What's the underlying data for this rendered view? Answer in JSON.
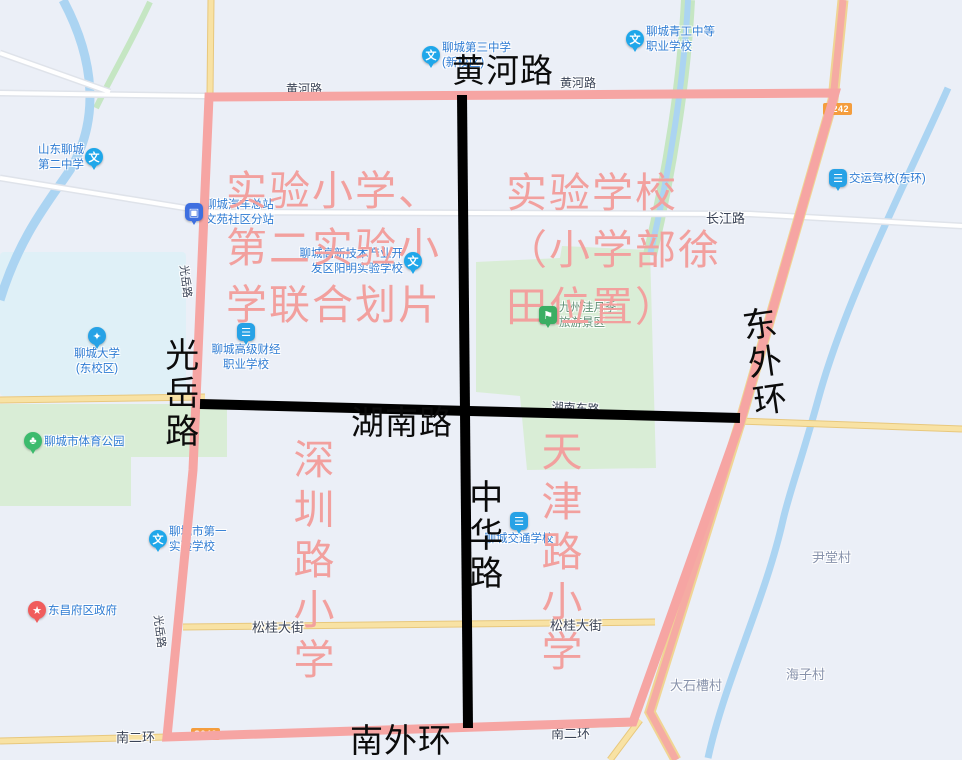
{
  "map": {
    "background_color": "#EBEFF7",
    "water_color": "#ABD4F2",
    "park_color": "#D9EDD6",
    "campus_color": "#DFF0F7",
    "road_yellow": "#F8E2A4",
    "expressway_color": "#F5ABA3",
    "pois": [
      {
        "id": "shandong-liaocheng-no2-middle-school",
        "lines": [
          "山东聊城",
          "第二中学"
        ],
        "icon": "school",
        "glyph": "文",
        "x": 94,
        "y": 157,
        "side": "left"
      },
      {
        "id": "liaocheng-no3-middle-school",
        "lines": [
          "聊城第三中学",
          "(新校区)"
        ],
        "icon": "school",
        "glyph": "文",
        "x": 431,
        "y": 55,
        "side": "right"
      },
      {
        "id": "liaocheng-qinggong-vocational-school",
        "lines": [
          "聊城青工中等",
          "职业学校"
        ],
        "icon": "school",
        "glyph": "文",
        "x": 635,
        "y": 39,
        "side": "right"
      },
      {
        "id": "jiaoyun-driving-school-donghuan",
        "lines": [
          "交运驾校(东环)"
        ],
        "icon": "drive",
        "glyph": "☰",
        "x": 838,
        "y": 178,
        "side": "right"
      },
      {
        "id": "bus-station-wenyuan-branch",
        "lines": [
          "聊城汽车总站",
          "文苑社区分站"
        ],
        "icon": "bus",
        "glyph": "▣",
        "x": 194,
        "y": 212,
        "side": "right"
      },
      {
        "id": "yangming-experimental-school",
        "lines": [
          "聊城高新技术产业开",
          "发区阳明实验学校"
        ],
        "icon": "school",
        "glyph": "文",
        "x": 413,
        "y": 261,
        "side": "left"
      },
      {
        "id": "liaocheng-university-east-campus",
        "lines": [
          "聊城大学",
          "(东校区)"
        ],
        "icon": "univ",
        "glyph": "✦",
        "x": 97,
        "y": 336,
        "side": "below"
      },
      {
        "id": "liaocheng-caijing-vocational-school",
        "lines": [
          "聊城高级财经",
          "职业学校"
        ],
        "icon": "drive",
        "glyph": "☰",
        "x": 246,
        "y": 332,
        "side": "below"
      },
      {
        "id": "liaocheng-sports-park",
        "lines": [
          "聊城市体育公园"
        ],
        "icon": "park",
        "glyph": "♣",
        "x": 33,
        "y": 441,
        "side": "right"
      },
      {
        "id": "dongchangfu-district-government",
        "lines": [
          "东昌府区政府"
        ],
        "icon": "gov",
        "glyph": "★",
        "x": 37,
        "y": 610,
        "side": "right"
      },
      {
        "id": "liaocheng-no1-experimental-school",
        "lines": [
          "聊城市第一",
          "实验学校"
        ],
        "icon": "school",
        "glyph": "文",
        "x": 158,
        "y": 539,
        "side": "right"
      },
      {
        "id": "liaocheng-traffic-school",
        "lines": [
          "聊城交通学校"
        ],
        "icon": "drive",
        "glyph": "☰",
        "x": 519,
        "y": 521,
        "side": "below"
      },
      {
        "id": "jiuzhouwa-rose-scenic-area",
        "lines": [
          "九州洼月季",
          "旅游景区"
        ],
        "icon": "scenic",
        "glyph": "⚑",
        "x": 548,
        "y": 315,
        "side": "right",
        "color": "#5E8F74"
      }
    ],
    "road_labels": [
      {
        "text": "黄河路",
        "x": 286,
        "y": 80,
        "size": 12
      },
      {
        "text": "黄河路",
        "x": 560,
        "y": 74,
        "size": 12
      },
      {
        "text": "长江路",
        "x": 706,
        "y": 208,
        "size": 13
      },
      {
        "text": "松桂大街",
        "x": 252,
        "y": 617,
        "size": 13
      },
      {
        "text": "松桂大街",
        "x": 550,
        "y": 615,
        "size": 13
      },
      {
        "text": "南二环",
        "x": 116,
        "y": 727,
        "size": 13
      },
      {
        "text": "南二环",
        "x": 551,
        "y": 723,
        "size": 13
      },
      {
        "text": "湖南东路",
        "x": 552,
        "y": 398,
        "size": 12,
        "rotate": 3
      },
      {
        "text": "光岳路",
        "x": 192,
        "y": 264,
        "size": 11,
        "rotate": 83
      },
      {
        "text": "光岳路",
        "x": 166,
        "y": 614,
        "size": 11,
        "rotate": 83
      },
      {
        "text": "尹堂村",
        "x": 812,
        "y": 547,
        "size": 13,
        "color": "#8792AB"
      },
      {
        "text": "海子村",
        "x": 786,
        "y": 664,
        "size": 13,
        "color": "#8792AB"
      },
      {
        "text": "大石槽村",
        "x": 670,
        "y": 675,
        "size": 13,
        "color": "#8792AB"
      }
    ],
    "badges": [
      {
        "text": "S242",
        "x": 823,
        "y": 103
      },
      {
        "text": "S242",
        "x": 191,
        "y": 728
      }
    ]
  },
  "annotations": {
    "border_color": "#F6A5A3",
    "cross_line_color": "#000000",
    "district_text_color": "#F2A09E",
    "road_labels": [
      {
        "text": "黄河路",
        "x": 452,
        "y": 54,
        "orient": "h"
      },
      {
        "text": "湖南路",
        "x": 351,
        "y": 406,
        "orient": "h"
      },
      {
        "text": "南外环",
        "x": 350,
        "y": 724,
        "orient": "h"
      },
      {
        "text": "中华路",
        "x": 464,
        "y": 479,
        "orient": "v"
      },
      {
        "text": "光岳路",
        "x": 160,
        "y": 337,
        "orient": "v"
      },
      {
        "text": "东外环",
        "x": 735,
        "y": 307,
        "orient": "v",
        "rotate": -8
      }
    ],
    "district_labels": [
      {
        "id": "district-northwest",
        "lines": [
          "实验小学、",
          "第二实验小",
          "学联合划片"
        ],
        "x": 226,
        "y": 163,
        "orient": "h"
      },
      {
        "id": "district-northeast",
        "lines": [
          "实验学校",
          "（小学部徐",
          "田位置）"
        ],
        "x": 506,
        "y": 165,
        "orient": "h"
      },
      {
        "id": "district-southwest",
        "lines": [
          "深圳路小学"
        ],
        "x": 288,
        "y": 438,
        "orient": "v"
      },
      {
        "id": "district-southeast",
        "lines": [
          "天津路小学"
        ],
        "x": 536,
        "y": 430,
        "orient": "v"
      }
    ]
  }
}
